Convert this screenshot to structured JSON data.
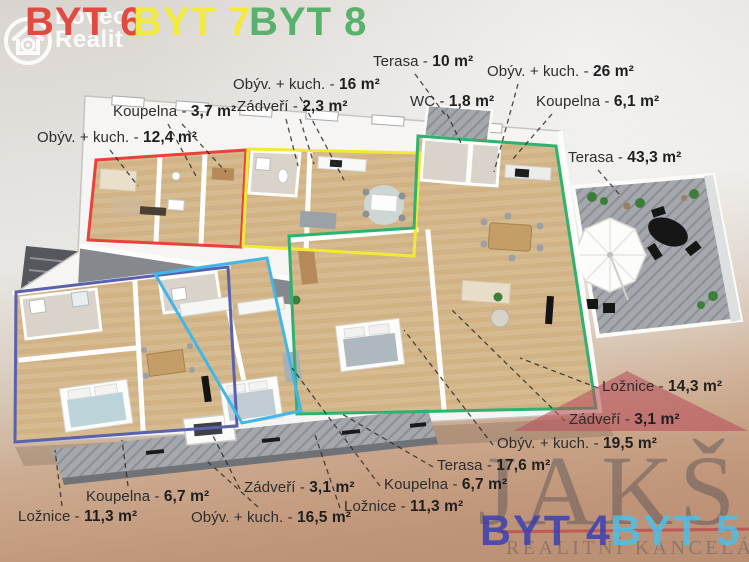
{
  "brand_logo": {
    "line1": "Lovec",
    "line2": "Realit"
  },
  "header_badges": [
    {
      "label": "BYT 6",
      "color": "#e14a40"
    },
    {
      "label": "BYT 7",
      "color": "#f3ea3e"
    },
    {
      "label": "BYT 8",
      "color": "#58b16c"
    }
  ],
  "labels": [
    {
      "name": "Koupelna - ",
      "value": "3,7 m²"
    },
    {
      "name": "Obýv. + kuch. - ",
      "value": "12,4 m²"
    },
    {
      "name": "Obýv. + kuch. - ",
      "value": "16 m²"
    },
    {
      "name": "Zádveří - ",
      "value": "2,3 m²"
    },
    {
      "name": "Terasa - ",
      "value": "10 m²"
    },
    {
      "name": "WC - ",
      "value": "1,8 m²"
    },
    {
      "name": "Obýv. + kuch. - ",
      "value": "26 m²"
    },
    {
      "name": "Koupelna - ",
      "value": "6,1 m²"
    },
    {
      "name": "Terasa - ",
      "value": "43,3 m²"
    },
    {
      "name": "Ložnice - ",
      "value": "14,3 m²"
    },
    {
      "name": "Zádveří - ",
      "value": "3,1 m²"
    },
    {
      "name": "Obýv. + kuch. - ",
      "value": "19,5 m²"
    },
    {
      "name": "Terasa - ",
      "value": "17,6 m²"
    },
    {
      "name": "Koupelna - ",
      "value": "6,7 m²"
    },
    {
      "name": "Ložnice - ",
      "value": "11,3 m²"
    },
    {
      "name": "Zádveří - ",
      "value": "3,1 m²"
    },
    {
      "name": "Koupelna - ",
      "value": "6,7 m²"
    },
    {
      "name": "Obýv. + kuch. - ",
      "value": "16,5 m²"
    },
    {
      "name": "Ložnice - ",
      "value": "11,3 m²"
    }
  ],
  "watermark": {
    "brand": "JAKŠ",
    "subtitle": "REALITNÍ KANCELÁŘ",
    "roof_color": "#b9525c",
    "badges": [
      {
        "label": "BYT 4",
        "color": "#3b40b5"
      },
      {
        "label": "BYT 5",
        "color": "#4bc0ea"
      }
    ]
  },
  "plan": {
    "units": [
      {
        "id": "byt-6",
        "outline_color": "#e8423a"
      },
      {
        "id": "byt-7",
        "outline_color": "#f2e838"
      },
      {
        "id": "byt-8",
        "outline_color": "#2fb170"
      },
      {
        "id": "byt-4",
        "outline_color": "#5a61ad"
      },
      {
        "id": "byt-5",
        "outline_color": "#41b6e8"
      }
    ]
  }
}
